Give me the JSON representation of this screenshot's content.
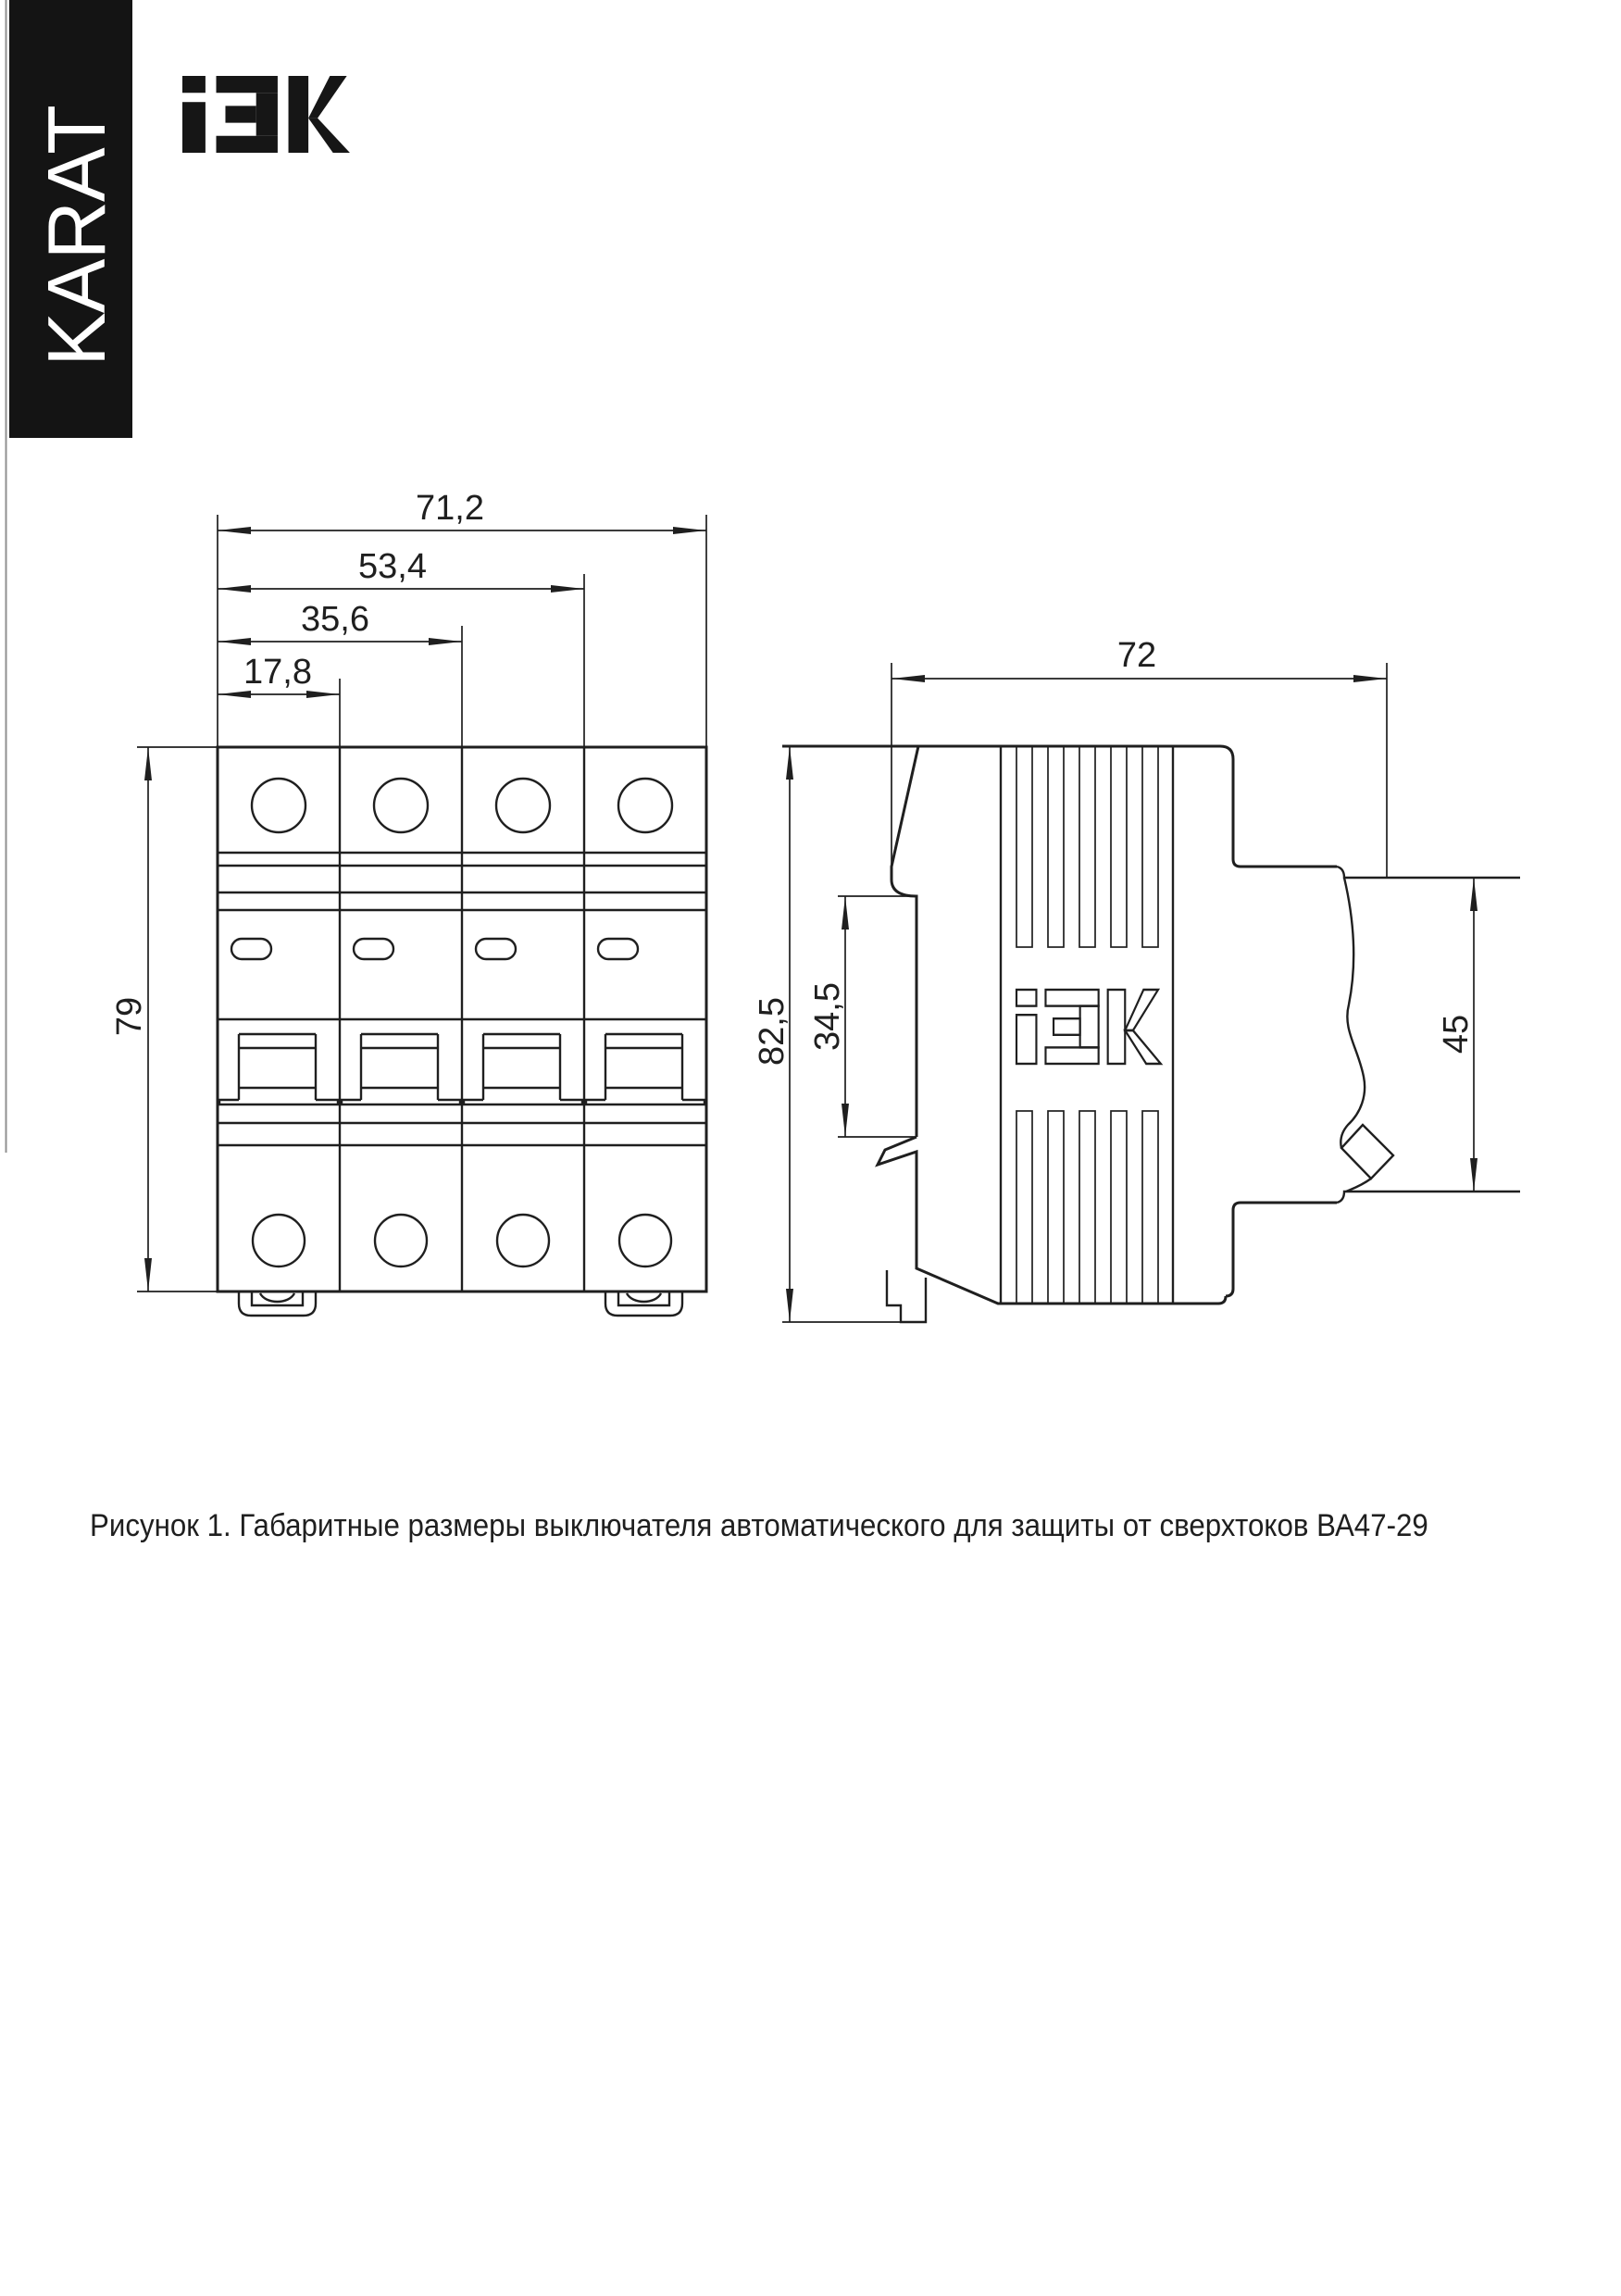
{
  "banner": {
    "label": "KARAT"
  },
  "brand": {
    "name": "IEK"
  },
  "caption": "Рисунок 1. Габаритные размеры выключателя автоматического для защиты от сверхтоков ВА47-29",
  "drawing": {
    "front_view": {
      "title": "front view of 4-pole circuit breaker",
      "dims": {
        "total_width": "71,2",
        "width_3_modules": "53,4",
        "width_2_modules": "35,6",
        "width_1_module": "17,8",
        "height": "79"
      }
    },
    "side_view": {
      "title": "side view of circuit breaker",
      "dims": {
        "depth": "72",
        "height_total": "82,5",
        "din_recess_height": "34,5",
        "front_height": "45"
      }
    },
    "product": "ВА47-29"
  },
  "colors": {
    "ink": "#1f1f1f",
    "paper": "#ffffff",
    "banner_bg": "#141414"
  }
}
